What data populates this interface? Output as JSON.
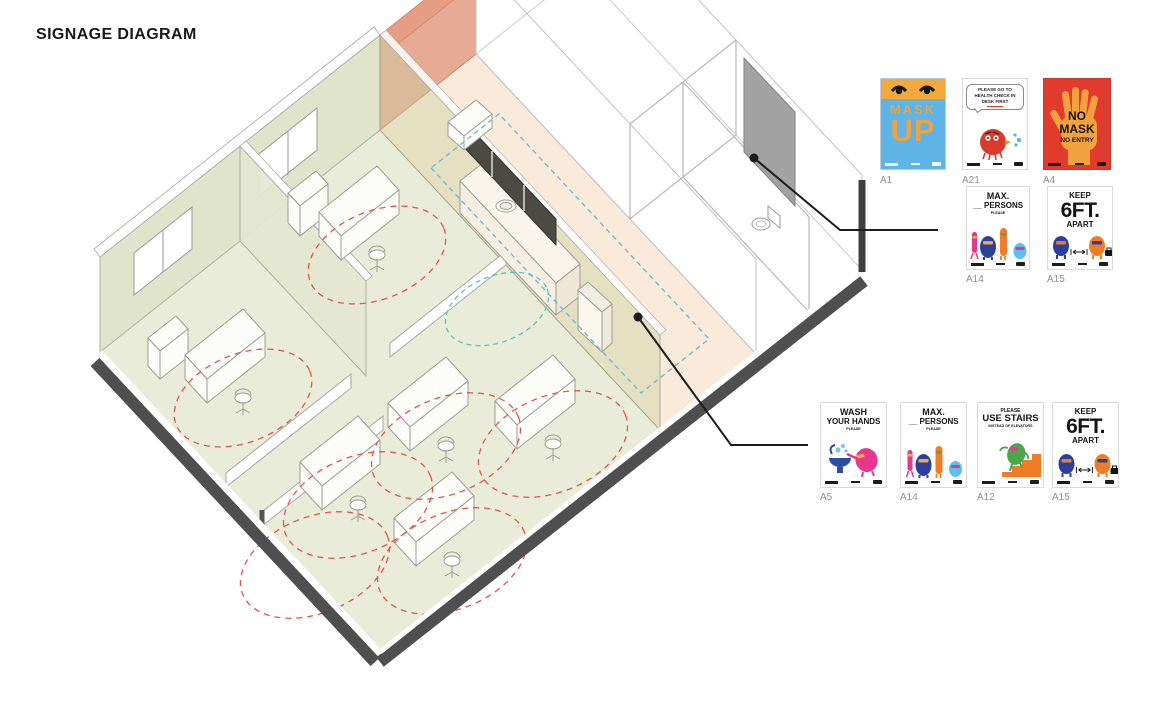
{
  "page": {
    "title": "SIGNAGE DIAGRAM"
  },
  "diagram": {
    "type": "axonometric-floor-plan",
    "rooms": [
      "private-office-1",
      "private-office-2",
      "open-office",
      "kitchen-pantry",
      "restroom",
      "entry"
    ],
    "legend": {
      "office_floor_color": "#e9ecd8",
      "pantry_floor_color": "#f9ead9",
      "highlight_wall_color": "#de8a6c",
      "door_panel_color": "#9b9b9b",
      "distancing_radius_color": "#e0564a",
      "circulation_path_color": "#6fbbd9",
      "secondary_path_color": "#58c3c3",
      "wall_base_color": "#4f4f4f"
    },
    "callouts": [
      {
        "id": "entry-door-panel",
        "links_to": "max-persons-and-6ft-posters"
      },
      {
        "id": "pantry-sink",
        "links_to": "hand-hygiene-poster-group"
      }
    ]
  },
  "posters": {
    "row1": [
      {
        "id": "A1",
        "line1": "MASK",
        "line2": "UP"
      },
      {
        "id": "A21",
        "bubble1": "PLEASE GO TO",
        "bubble2": "HEALTH CHECK IN",
        "bubble3": "DESK FIRST"
      },
      {
        "id": "A4",
        "line1": "NO",
        "line2": "MASK",
        "line3": "NO ENTRY"
      }
    ],
    "row2": [
      {
        "id": "A14",
        "line1": "MAX.",
        "line2": "__ PERSONS",
        "line3": "PLEASE"
      },
      {
        "id": "A15",
        "line1": "KEEP",
        "line2": "6FT.",
        "line3": "APART"
      }
    ],
    "row3": [
      {
        "id": "A5",
        "line1": "WASH",
        "line2": "YOUR HANDS",
        "line3": "PLEASE"
      },
      {
        "id": "A14",
        "line1": "MAX.",
        "line2": "__ PERSONS",
        "line3": "PLEASE"
      },
      {
        "id": "A12",
        "line1": "PLEASE",
        "line2": "USE STAIRS",
        "line3": "INSTEAD OF ELEVATORS"
      },
      {
        "id": "A15",
        "line1": "KEEP",
        "line2": "6FT.",
        "line3": "APART"
      }
    ]
  }
}
